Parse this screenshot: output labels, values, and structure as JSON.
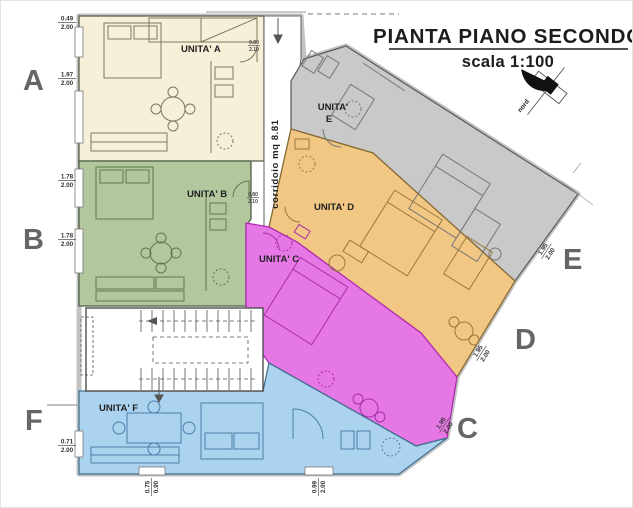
{
  "title": {
    "main": "PIANTA PIANO SECONDO",
    "scale": "scala 1:100"
  },
  "compass": {
    "label": "nord"
  },
  "corridor": {
    "label": "corridoio  mq 8.81"
  },
  "units": {
    "a": {
      "letter": "A",
      "label": "UNITA' A",
      "color": "#f7f0d8",
      "line": "#7d7760"
    },
    "b": {
      "letter": "B",
      "label": "UNITA' B",
      "color": "#b3c79e",
      "line": "#5f7a4e"
    },
    "c": {
      "letter": "C",
      "label": "UNITA' C",
      "color": "#e678e6",
      "line": "#a62fa6"
    },
    "d": {
      "letter": "D",
      "label": "UNITA' D",
      "color": "#f2c783",
      "line": "#9a7a3e"
    },
    "e": {
      "letter": "E",
      "label_line1": "UNITA'",
      "label_line2": "E",
      "color": "#c9c9c9",
      "line": "#777777"
    },
    "f": {
      "letter": "F",
      "label": "UNITA' F",
      "color": "#abd3ef",
      "line": "#4d7da8"
    }
  },
  "dimensions": {
    "left": [
      {
        "w": "0.49",
        "h": "2.00"
      },
      {
        "w": "1.97",
        "h": "2.00"
      },
      {
        "w": "1.78",
        "h": "2.00"
      },
      {
        "w": "1.78",
        "h": "2.00"
      },
      {
        "w": "0.71",
        "h": "2.00"
      }
    ],
    "bottom": [
      {
        "w": "0.75",
        "h": "0.90"
      },
      {
        "w": "0.99",
        "h": "2.00"
      }
    ],
    "diagonal": [
      {
        "w": "1.95",
        "h": "2.00"
      },
      {
        "w": "1.95",
        "h": "2.00"
      },
      {
        "w": "1.95",
        "h": "2.00"
      }
    ],
    "doors": [
      {
        "w": "0.80",
        "h": "2.10"
      },
      {
        "w": "0.80",
        "h": "2.10"
      }
    ]
  },
  "colors": {
    "walls": "#4f4f4f",
    "letters": "#666666",
    "outline": "#c2c2c2",
    "stairs": "#555555"
  }
}
